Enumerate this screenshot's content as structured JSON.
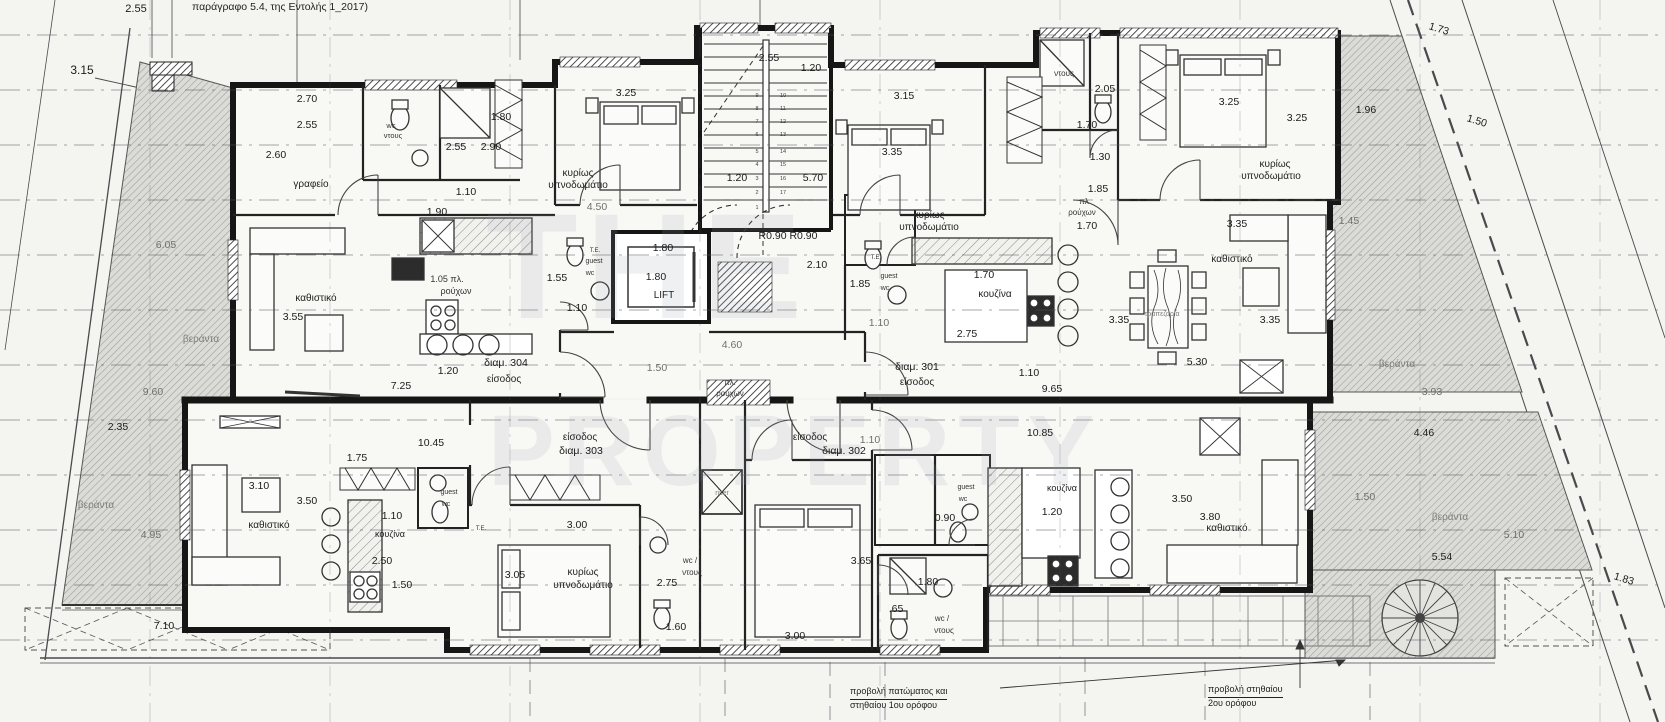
{
  "header": {
    "note": "παράγραφο 5.4, της Εντολής 1_2017)"
  },
  "notes": {
    "n1a": "προβολή πατώματος και",
    "n1b": "στηθαίου 1ου ορόφου",
    "n2a": "προβολή στηθαίου",
    "n2b": "2ου ορόφου"
  },
  "colors": {
    "paper": "#f4f4f1",
    "ink": "#161616",
    "hatch": "#a0a09c",
    "grid": "#4a4a4e",
    "watermark": "#97a0ac"
  },
  "apartments": [
    {
      "id": "διαμ. 301",
      "entrance_label": "είσοδος"
    },
    {
      "id": "διαμ. 302",
      "entrance_label": "είσοδος"
    },
    {
      "id": "διαμ. 303",
      "entrance_label": "είσοδος"
    },
    {
      "id": "διαμ. 304",
      "entrance_label": "είσοδος"
    }
  ],
  "plan": {
    "labels": [
      {
        "t": "THE",
        "x": 648,
        "y": 318,
        "s": 150,
        "c": "w"
      },
      {
        "t": "PROPERTY",
        "x": 795,
        "y": 485,
        "s": 100,
        "c": "w"
      },
      {
        "t": "2.55",
        "x": 136,
        "y": 12,
        "s": 11
      },
      {
        "t": "3.15",
        "x": 82,
        "y": 74,
        "s": 12
      },
      {
        "t": "2.70",
        "x": 307,
        "y": 102
      },
      {
        "t": "2.55",
        "x": 307,
        "y": 128
      },
      {
        "t": "2.60",
        "x": 276,
        "y": 158
      },
      {
        "t": "wc",
        "x": 391,
        "y": 128,
        "s": 7.5,
        "c": "t"
      },
      {
        "t": "ντους",
        "x": 393,
        "y": 138,
        "s": 7.5,
        "c": "t"
      },
      {
        "t": "2.55",
        "x": 456,
        "y": 150
      },
      {
        "t": "2.90",
        "x": 491,
        "y": 150
      },
      {
        "t": "1.80",
        "x": 501,
        "y": 120
      },
      {
        "t": "γραφείο",
        "x": 311,
        "y": 187,
        "s": 10,
        "c": "r"
      },
      {
        "t": "1.10",
        "x": 466,
        "y": 195
      },
      {
        "t": "1.90",
        "x": 437,
        "y": 215
      },
      {
        "t": "κυρίως",
        "x": 578,
        "y": 176,
        "s": 10,
        "c": "r"
      },
      {
        "t": "υπνοδωμάτιο",
        "x": 578,
        "y": 188,
        "s": 10,
        "c": "r"
      },
      {
        "t": "3.25",
        "x": 626,
        "y": 96
      },
      {
        "t": "4.50",
        "x": 597,
        "y": 210,
        "c": "g"
      },
      {
        "t": "2.55",
        "x": 769,
        "y": 61
      },
      {
        "t": "1.20",
        "x": 811,
        "y": 71
      },
      {
        "t": "1.20",
        "x": 737,
        "y": 181
      },
      {
        "t": "5.70",
        "x": 813,
        "y": 181
      },
      {
        "t": "R0.90 R0.90",
        "x": 788,
        "y": 239
      },
      {
        "t": "2.10",
        "x": 817,
        "y": 268
      },
      {
        "t": "1.80",
        "x": 663,
        "y": 251
      },
      {
        "t": "1.80",
        "x": 656,
        "y": 280
      },
      {
        "t": "LIFT",
        "x": 664,
        "y": 298,
        "s": 10,
        "c": "r"
      },
      {
        "t": "4.60",
        "x": 732,
        "y": 348,
        "c": "g"
      },
      {
        "t": "1.50",
        "x": 657,
        "y": 371,
        "c": "g"
      },
      {
        "t": "πλ.",
        "x": 730,
        "y": 385,
        "s": 8,
        "c": "t"
      },
      {
        "t": "ρούχων",
        "x": 730,
        "y": 396,
        "s": 8,
        "c": "t"
      },
      {
        "t": "3.15",
        "x": 904,
        "y": 99
      },
      {
        "t": "3.35",
        "x": 892,
        "y": 155
      },
      {
        "t": "κυρίως",
        "x": 929,
        "y": 218,
        "s": 10,
        "c": "r"
      },
      {
        "t": "υπνοδωμάτιο",
        "x": 929,
        "y": 230,
        "s": 10,
        "c": "r"
      },
      {
        "t": "ντους",
        "x": 1064,
        "y": 76,
        "s": 8,
        "c": "t"
      },
      {
        "t": "2.05",
        "x": 1105,
        "y": 92
      },
      {
        "t": "1.70",
        "x": 1087,
        "y": 128
      },
      {
        "t": "1.30",
        "x": 1100,
        "y": 160
      },
      {
        "t": "1.85",
        "x": 1098,
        "y": 192
      },
      {
        "t": "πλ",
        "x": 1084,
        "y": 204,
        "s": 8,
        "c": "t"
      },
      {
        "t": "ρούχων",
        "x": 1082,
        "y": 215,
        "s": 8,
        "c": "t"
      },
      {
        "t": "1.70",
        "x": 1087,
        "y": 229
      },
      {
        "t": "3.25",
        "x": 1229,
        "y": 105
      },
      {
        "t": "3.25",
        "x": 1297,
        "y": 121
      },
      {
        "t": "1.96",
        "x": 1366,
        "y": 113
      },
      {
        "t": "1.73",
        "x": 1438,
        "y": 32,
        "r": 17
      },
      {
        "t": "1.50",
        "x": 1476,
        "y": 124,
        "r": 17
      },
      {
        "t": "κυρίως",
        "x": 1275,
        "y": 167,
        "s": 10,
        "c": "r"
      },
      {
        "t": "υπνοδωμάτιο",
        "x": 1271,
        "y": 179,
        "s": 10,
        "c": "r"
      },
      {
        "t": "3.35",
        "x": 1237,
        "y": 227
      },
      {
        "t": "1.45",
        "x": 1349,
        "y": 224,
        "c": "g"
      },
      {
        "t": "καθιστικό",
        "x": 1232,
        "y": 262,
        "s": 10,
        "c": "r"
      },
      {
        "t": "3.35",
        "x": 1270,
        "y": 323
      },
      {
        "t": "τραπεζαρία",
        "x": 1162,
        "y": 316,
        "s": 7,
        "c": "gr"
      },
      {
        "t": "5.30",
        "x": 1197,
        "y": 365
      },
      {
        "t": "βεράντα",
        "x": 1397,
        "y": 367,
        "s": 10,
        "c": "gr"
      },
      {
        "t": "3.93",
        "x": 1432,
        "y": 395,
        "c": "g"
      },
      {
        "t": "1.85",
        "x": 860,
        "y": 287
      },
      {
        "t": "Τ.Ε.",
        "x": 876,
        "y": 259,
        "s": 6,
        "c": "m"
      },
      {
        "t": "guest",
        "x": 889,
        "y": 278,
        "s": 7,
        "c": "t"
      },
      {
        "t": "wc",
        "x": 885,
        "y": 290,
        "s": 7,
        "c": "t"
      },
      {
        "t": "1.10",
        "x": 879,
        "y": 326,
        "c": "g"
      },
      {
        "t": "1.70",
        "x": 984,
        "y": 278
      },
      {
        "t": "κουζίνα",
        "x": 995,
        "y": 297,
        "s": 10,
        "c": "r"
      },
      {
        "t": "2.75",
        "x": 967,
        "y": 337
      },
      {
        "t": "3.35",
        "x": 1119,
        "y": 323
      },
      {
        "t": "διαμ. 301",
        "x": 917,
        "y": 370
      },
      {
        "t": "είσοδος",
        "x": 917,
        "y": 385,
        "s": 10,
        "c": "r"
      },
      {
        "t": "1.10",
        "x": 1029,
        "y": 376
      },
      {
        "t": "9.65",
        "x": 1052,
        "y": 392
      },
      {
        "t": "καθιστικό",
        "x": 316,
        "y": 301,
        "s": 10,
        "c": "r"
      },
      {
        "t": "3.55",
        "x": 293,
        "y": 320
      },
      {
        "t": "1.05 πλ.",
        "x": 447,
        "y": 282,
        "s": 9,
        "c": "t"
      },
      {
        "t": "ρούχων",
        "x": 456,
        "y": 294,
        "s": 9,
        "c": "t"
      },
      {
        "t": "1.55",
        "x": 557,
        "y": 281
      },
      {
        "t": "1.10",
        "x": 577,
        "y": 311
      },
      {
        "t": "Τ.Ε.",
        "x": 595,
        "y": 252,
        "s": 6,
        "c": "m"
      },
      {
        "t": "guest",
        "x": 594,
        "y": 263,
        "s": 7,
        "c": "t"
      },
      {
        "t": "wc",
        "x": 590,
        "y": 275,
        "s": 7,
        "c": "t"
      },
      {
        "t": "διαμ. 304",
        "x": 506,
        "y": 366
      },
      {
        "t": "είσοδος",
        "x": 504,
        "y": 382,
        "s": 10,
        "c": "r"
      },
      {
        "t": "1.20",
        "x": 448,
        "y": 374
      },
      {
        "t": "7.25",
        "x": 401,
        "y": 389
      },
      {
        "t": "6.05",
        "x": 166,
        "y": 248,
        "c": "g"
      },
      {
        "t": "βεράντα",
        "x": 201,
        "y": 342,
        "s": 10,
        "c": "gr"
      },
      {
        "t": "9.60",
        "x": 153,
        "y": 395,
        "c": "g"
      },
      {
        "t": "2.35",
        "x": 118,
        "y": 430
      },
      {
        "t": "βεράντα",
        "x": 96,
        "y": 508,
        "s": 10,
        "c": "gr"
      },
      {
        "t": "4.95",
        "x": 151,
        "y": 538,
        "c": "g"
      },
      {
        "t": "7.10",
        "x": 164,
        "y": 629
      },
      {
        "t": "10.45",
        "x": 431,
        "y": 446
      },
      {
        "t": "1.75",
        "x": 357,
        "y": 461
      },
      {
        "t": "3.10",
        "x": 259,
        "y": 489
      },
      {
        "t": "3.50",
        "x": 307,
        "y": 504
      },
      {
        "t": "καθιστικό",
        "x": 269,
        "y": 528,
        "s": 10,
        "c": "r"
      },
      {
        "t": "1.10",
        "x": 392,
        "y": 519
      },
      {
        "t": "κουζίνα",
        "x": 390,
        "y": 537,
        "s": 9,
        "c": "r"
      },
      {
        "t": "2.50",
        "x": 382,
        "y": 564
      },
      {
        "t": "1.50",
        "x": 402,
        "y": 588
      },
      {
        "t": "guest",
        "x": 449,
        "y": 494,
        "s": 7,
        "c": "t"
      },
      {
        "t": "wc",
        "x": 446,
        "y": 506,
        "s": 7,
        "c": "t"
      },
      {
        "t": "Τ.Ε.",
        "x": 481,
        "y": 530,
        "s": 6,
        "c": "m"
      },
      {
        "t": "είσοδος",
        "x": 580,
        "y": 440,
        "s": 10,
        "c": "r"
      },
      {
        "t": "διαμ. 303",
        "x": 581,
        "y": 454
      },
      {
        "t": "3.00",
        "x": 577,
        "y": 528
      },
      {
        "t": "3.05",
        "x": 515,
        "y": 578
      },
      {
        "t": "κυρίως",
        "x": 583,
        "y": 575,
        "s": 10,
        "c": "r"
      },
      {
        "t": "υπνοδωμάτιο",
        "x": 583,
        "y": 588,
        "s": 10,
        "c": "r"
      },
      {
        "t": "2.75",
        "x": 667,
        "y": 586
      },
      {
        "t": "wc /",
        "x": 690,
        "y": 563,
        "s": 8,
        "c": "t"
      },
      {
        "t": "ντους",
        "x": 692,
        "y": 575,
        "s": 8,
        "c": "t"
      },
      {
        "t": "1.60",
        "x": 676,
        "y": 630
      },
      {
        "t": "3.00",
        "x": 795,
        "y": 639
      },
      {
        "t": "riser",
        "x": 722,
        "y": 495,
        "s": 7,
        "c": "gr"
      },
      {
        "t": "1.10",
        "x": 870,
        "y": 443,
        "c": "g"
      },
      {
        "t": "είσοδος",
        "x": 810,
        "y": 440,
        "s": 10,
        "c": "r"
      },
      {
        "t": "διαμ. 302",
        "x": 844,
        "y": 454
      },
      {
        "t": "10.85",
        "x": 1040,
        "y": 436
      },
      {
        "t": "3.65",
        "x": 861,
        "y": 564
      },
      {
        "t": "guest",
        "x": 966,
        "y": 489,
        "s": 7,
        "c": "t"
      },
      {
        "t": "wc",
        "x": 963,
        "y": 501,
        "s": 7,
        "c": "t"
      },
      {
        "t": "0.90",
        "x": 945,
        "y": 521
      },
      {
        "t": "1.80",
        "x": 928,
        "y": 585
      },
      {
        "t": ".65",
        "x": 896,
        "y": 612
      },
      {
        "t": "wc /",
        "x": 942,
        "y": 621,
        "s": 8,
        "c": "t"
      },
      {
        "t": "ντους",
        "x": 944,
        "y": 633,
        "s": 8,
        "c": "t"
      },
      {
        "t": "κουζίνα",
        "x": 1062,
        "y": 491,
        "s": 9,
        "c": "r"
      },
      {
        "t": "1.20",
        "x": 1052,
        "y": 515
      },
      {
        "t": "3.50",
        "x": 1182,
        "y": 502
      },
      {
        "t": "3.80",
        "x": 1210,
        "y": 520
      },
      {
        "t": "καθιστικό",
        "x": 1227,
        "y": 531,
        "s": 10,
        "c": "r"
      },
      {
        "t": "4.46",
        "x": 1424,
        "y": 436
      },
      {
        "t": "1.50",
        "x": 1365,
        "y": 500,
        "c": "g"
      },
      {
        "t": "βεράντα",
        "x": 1450,
        "y": 520,
        "s": 10,
        "c": "gr"
      },
      {
        "t": "5.10",
        "x": 1514,
        "y": 538,
        "c": "g"
      },
      {
        "t": "5.54",
        "x": 1442,
        "y": 560
      },
      {
        "t": "1.83",
        "x": 1623,
        "y": 582,
        "r": 17
      },
      {
        "t": "9",
        "x": 757,
        "y": 97,
        "s": 5.5,
        "c": "s"
      },
      {
        "t": "8",
        "x": 757,
        "y": 110,
        "s": 5.5,
        "c": "s"
      },
      {
        "t": "7",
        "x": 757,
        "y": 123,
        "s": 5.5,
        "c": "s"
      },
      {
        "t": "6",
        "x": 757,
        "y": 136,
        "s": 5.5,
        "c": "s"
      },
      {
        "t": "5",
        "x": 757,
        "y": 153,
        "s": 5.5,
        "c": "s"
      },
      {
        "t": "4",
        "x": 757,
        "y": 166,
        "s": 5.5,
        "c": "s"
      },
      {
        "t": "3",
        "x": 757,
        "y": 180,
        "s": 5.5,
        "c": "s"
      },
      {
        "t": "2",
        "x": 757,
        "y": 194,
        "s": 5.5,
        "c": "s"
      },
      {
        "t": "1",
        "x": 757,
        "y": 209,
        "s": 5.5,
        "c": "s"
      },
      {
        "t": "10",
        "x": 783,
        "y": 97,
        "s": 5.5,
        "c": "s"
      },
      {
        "t": "11",
        "x": 783,
        "y": 110,
        "s": 5.5,
        "c": "s"
      },
      {
        "t": "12",
        "x": 783,
        "y": 123,
        "s": 5.5,
        "c": "s"
      },
      {
        "t": "13",
        "x": 783,
        "y": 136,
        "s": 5.5,
        "c": "s"
      },
      {
        "t": "14",
        "x": 783,
        "y": 153,
        "s": 5.5,
        "c": "s"
      },
      {
        "t": "15",
        "x": 783,
        "y": 166,
        "s": 5.5,
        "c": "s"
      },
      {
        "t": "16",
        "x": 783,
        "y": 180,
        "s": 5.5,
        "c": "s"
      },
      {
        "t": "17",
        "x": 783,
        "y": 194,
        "s": 5.5,
        "c": "s"
      }
    ]
  }
}
